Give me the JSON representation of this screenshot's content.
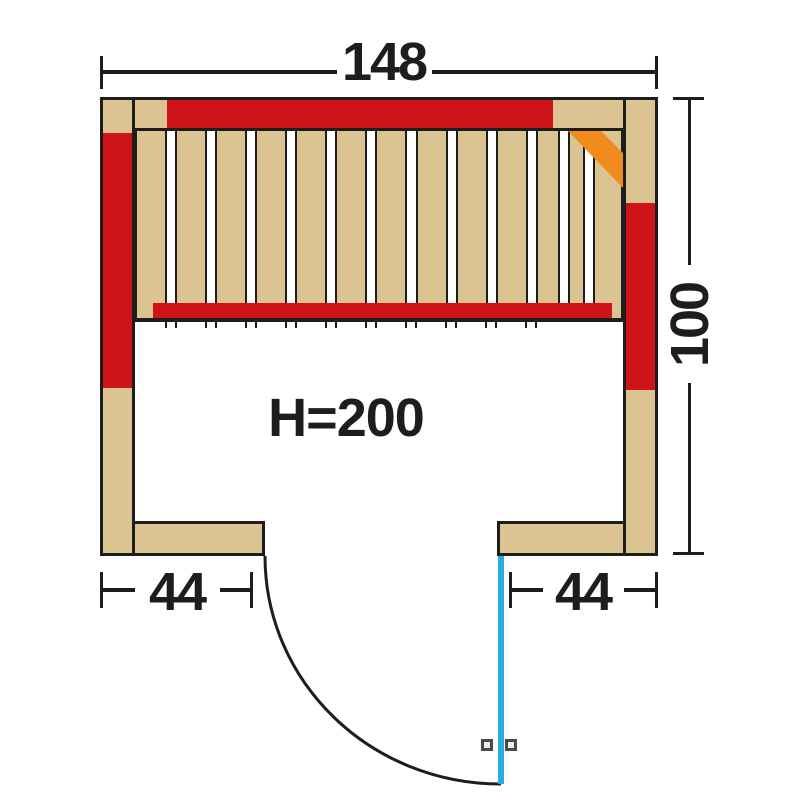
{
  "diagram_title": "sauna-floor-plan",
  "colors": {
    "wood": "#dcc492",
    "heater": "#ce1419",
    "accent": "#f08c1e",
    "door": "#29abe2",
    "line": "#1d1d1b",
    "handle-line": "#4a4a4c",
    "handle-fill": "#ececec"
  },
  "dimensions": {
    "width": {
      "label": "148"
    },
    "depth": {
      "label": "100"
    },
    "door_left": {
      "label": "44"
    },
    "door_right": {
      "label": "44"
    }
  },
  "interior": {
    "height_label": "H=200"
  },
  "bench": {
    "slat_count": 13,
    "slat_widths_px": [
      32,
      32,
      32,
      32,
      32,
      32,
      32,
      32,
      32,
      32,
      24,
      17,
      30
    ]
  }
}
